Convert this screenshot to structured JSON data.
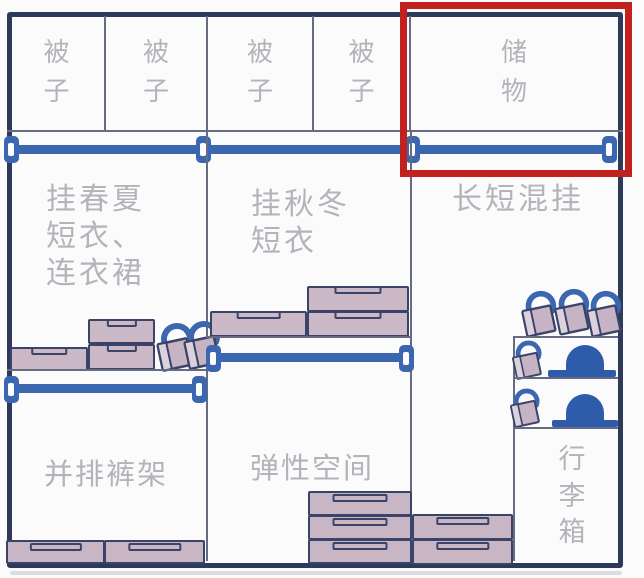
{
  "wardrobe": {
    "top_row": {
      "compartments": [
        {
          "label": "被子"
        },
        {
          "label": "被子"
        },
        {
          "label": "被子"
        },
        {
          "label": "被子"
        },
        {
          "label": "储物",
          "highlighted": true
        }
      ]
    },
    "hang_sections": {
      "spring_summer": {
        "lines": [
          "挂春夏",
          "短衣、",
          "连衣裙"
        ]
      },
      "autumn_winter": {
        "lines": [
          "挂秋冬",
          "短衣"
        ]
      },
      "mixed": {
        "label": "长短混挂"
      }
    },
    "lower_zones": {
      "pants_rack": "并排裤架",
      "flexible_space": "弹性空间",
      "suitcase": "行李箱"
    },
    "annotation": {
      "highlighted_label": "储物",
      "highlight_color": "#c2221e"
    },
    "colors": {
      "frame": "#2e3a59",
      "rod_blue": "#3a67b0",
      "box_fill": "#cbb9c7",
      "dome_blue": "#2e5cab",
      "label_text": "#b6b2ba"
    }
  }
}
